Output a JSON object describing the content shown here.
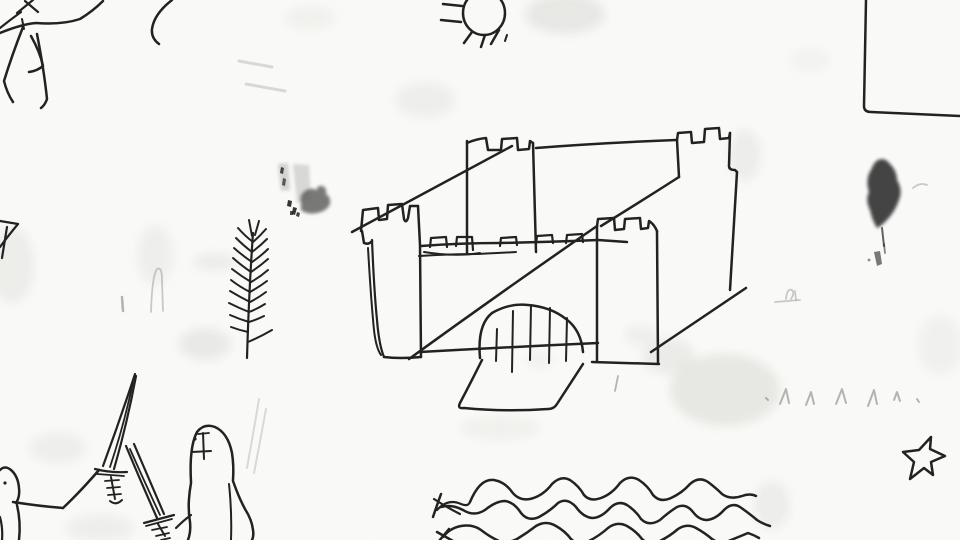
{
  "scene": {
    "description": "Child-style black ink drawing on white paper: a large castle with four crenellated towers, an arched gate with portcullis bars and a drawbridge path; a sun with rays at top center; a partial stick horse at top left; a box outline corner at top right; a dark inked leaf blob on the right; a fern branch on the left; a partial star at the left edge; two knight figures with crossed swords at bottom left; three wavy water lines at bottom center; a five-pointed star at bottom right; faint pencil zigzag marks, an ink smudge and soft watercolor stains scattered on the paper.",
    "elements": [
      "horse-sketch-partial",
      "curved-line",
      "sun-with-rays",
      "box-outline-corner",
      "ink-leaf-blob",
      "fern-branch",
      "castle",
      "castle-gate-arch-with-portcullis",
      "drawbridge-path",
      "left-edge-star-partial",
      "knight-figure-left",
      "crossed-swords",
      "knight-figure-right",
      "water-waves",
      "five-pointed-star",
      "pencil-zigzag-marks",
      "ink-smudge",
      "watercolor-stains"
    ]
  },
  "palette": {
    "paper": "#fafaf8",
    "ink": "#212121",
    "pencil": "#8f8f8c",
    "stain": "#d8d8d3",
    "smudge_dark": "#1e1e1c",
    "smudge_mid": "#585856",
    "smudge_soft": "#9a9a97"
  }
}
